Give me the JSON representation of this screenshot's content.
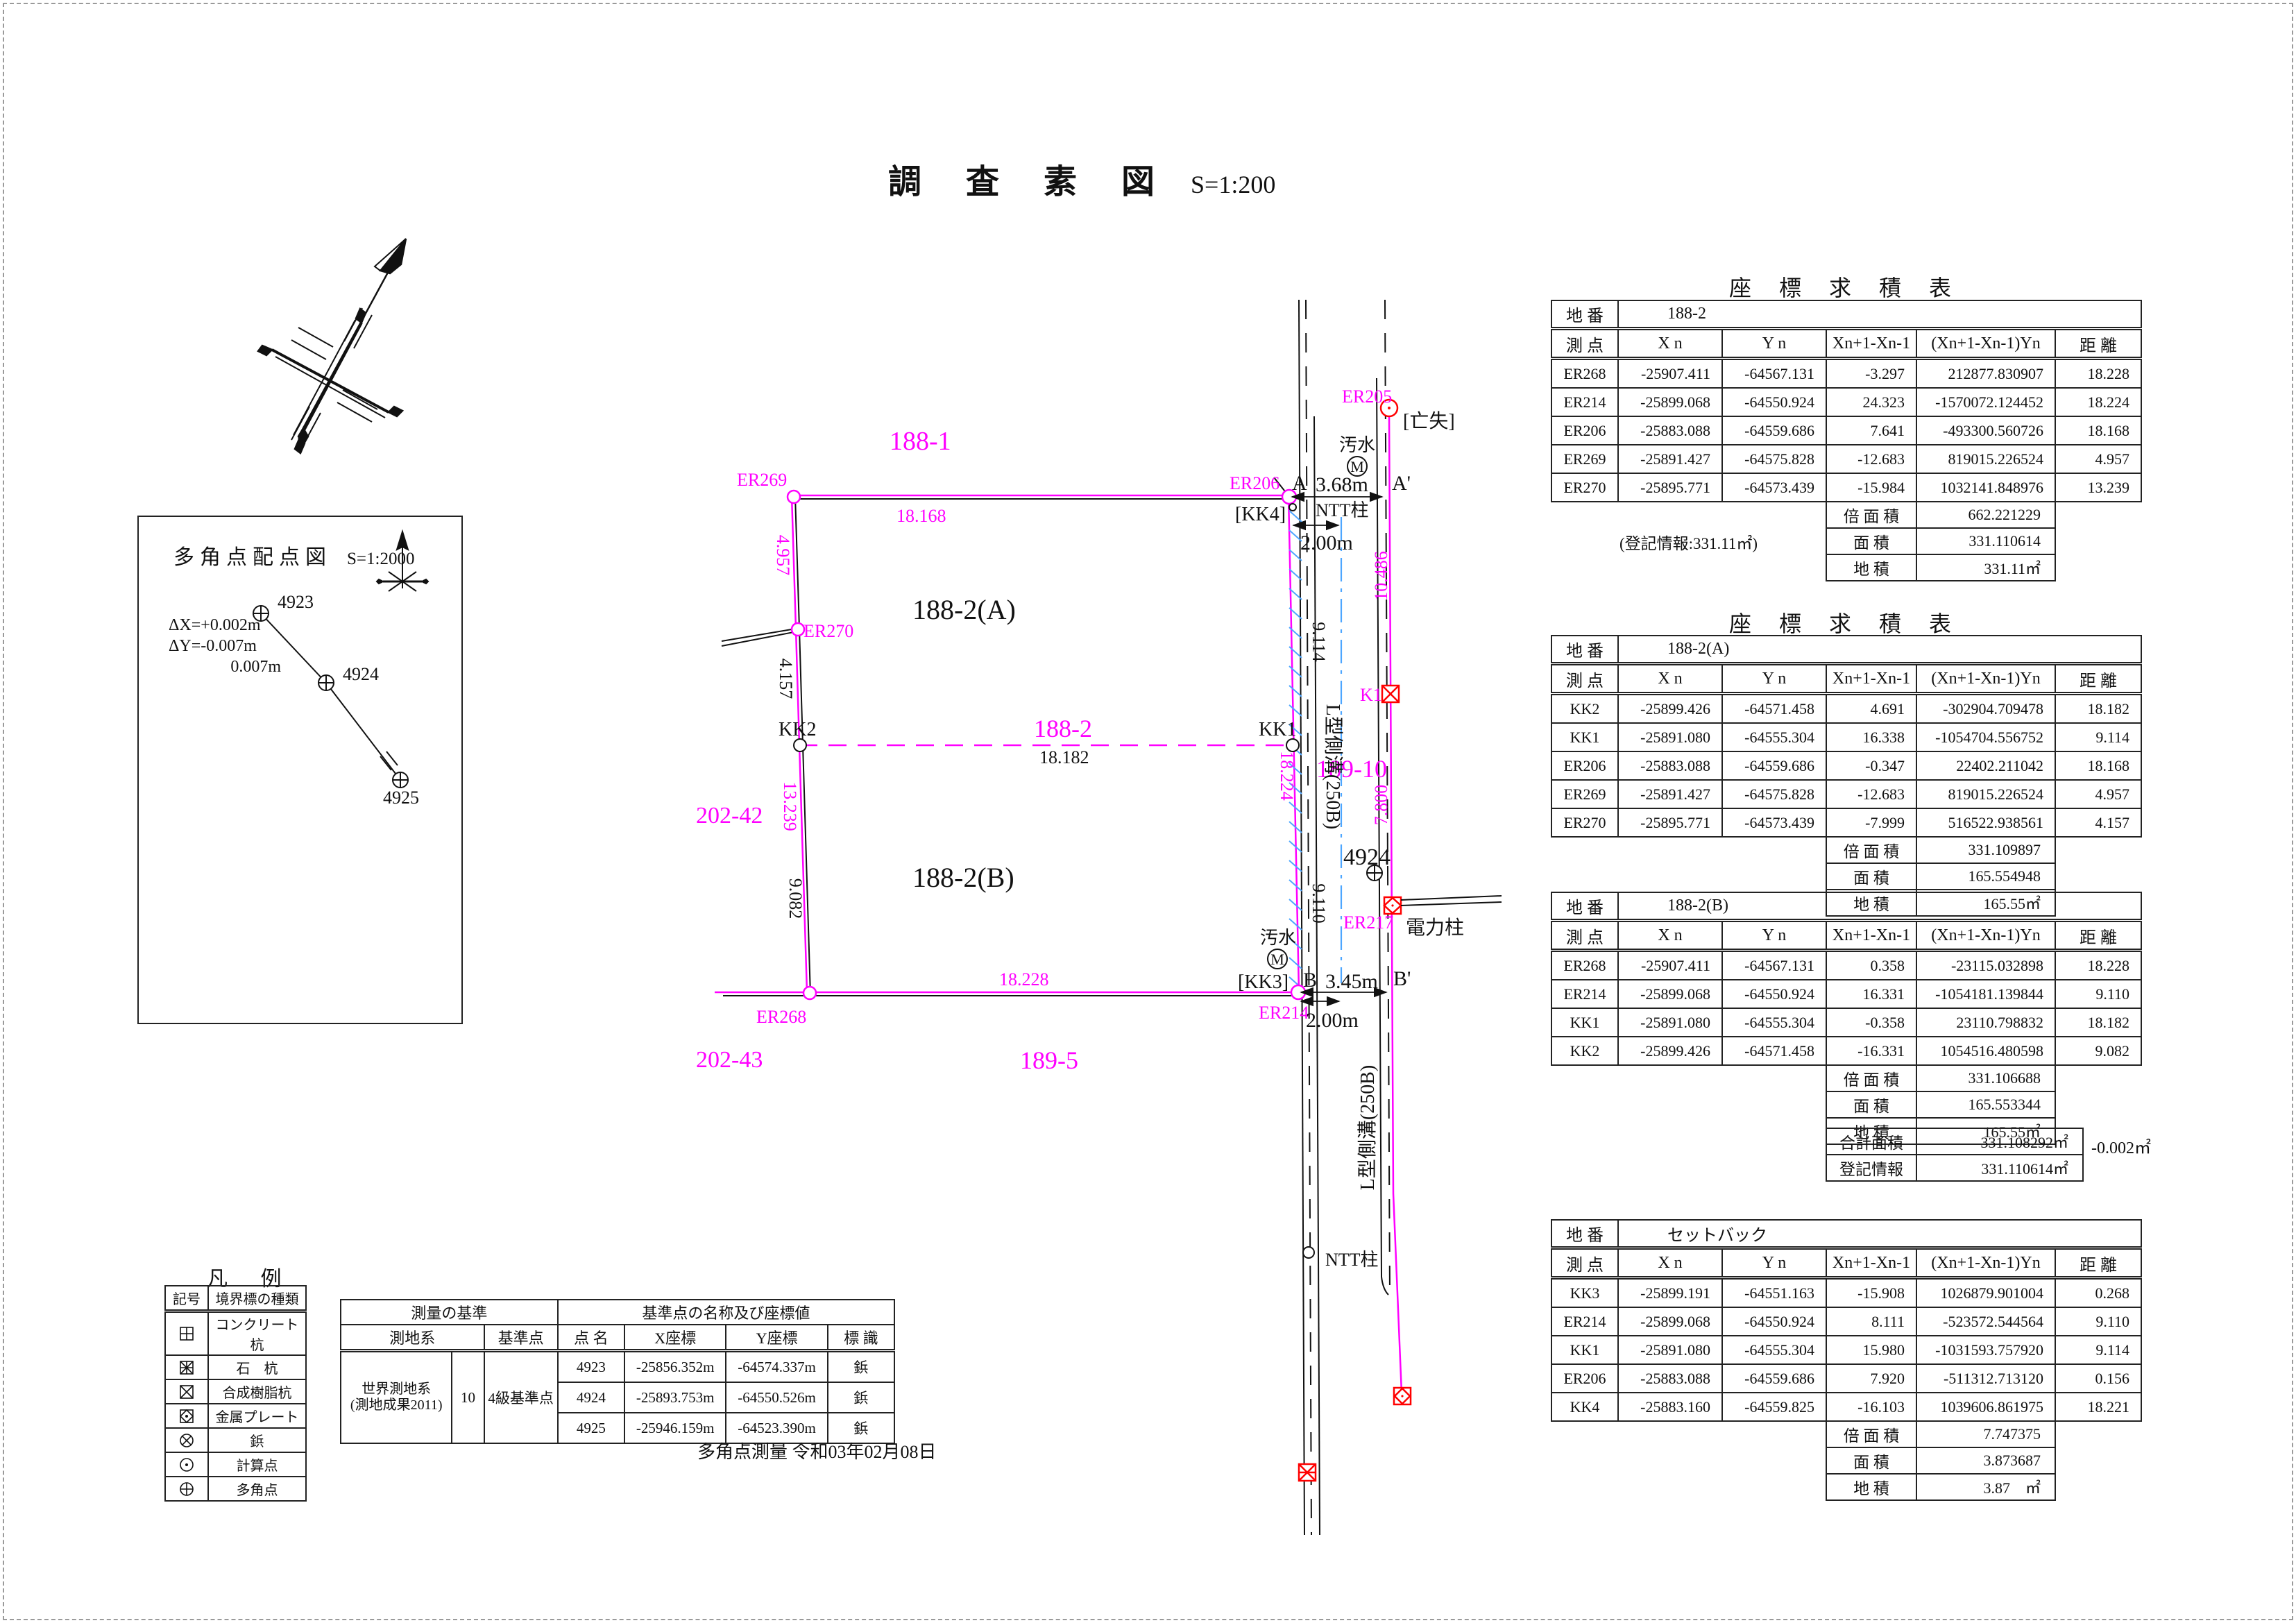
{
  "page": {
    "title_main": "調 査 素 図",
    "title_scale": "S=1:200"
  },
  "inset": {
    "title": "多角点配点図",
    "scale": "S=1:2000",
    "dx": "ΔX=+0.002m",
    "dy": "ΔY=-0.007m",
    "dist": "0.007m",
    "p1": "4923",
    "p2": "4924",
    "p3": "4925"
  },
  "legend": {
    "title": "凡 例",
    "col1": "記号",
    "col2": "境界標の種類",
    "items": [
      {
        "symbol": "concrete-pile-icon",
        "label": "コンクリート杭"
      },
      {
        "symbol": "stone-pile-icon",
        "label": "石　杭"
      },
      {
        "symbol": "resin-pile-icon",
        "label": "合成樹脂杭"
      },
      {
        "symbol": "metal-plate-icon",
        "label": "金属プレート"
      },
      {
        "symbol": "tack-icon",
        "label": "鋲"
      },
      {
        "symbol": "calc-point-icon",
        "label": "計算点"
      },
      {
        "symbol": "traverse-point-icon",
        "label": "多角点"
      }
    ]
  },
  "basis": {
    "h_left": "測量の基準",
    "h_right": "基準点の名称及び座標値",
    "h_datum": "測地系",
    "h_kijun": "基準点",
    "h_name": "点 名",
    "h_x": "X座標",
    "h_y": "Y座標",
    "h_mark": "標 識",
    "datum1": "世界測地系",
    "datum2": "(測地成果2011)",
    "num": "10",
    "kijun": "4級基準点",
    "rows": [
      [
        "4923",
        "-25856.352m",
        "-64574.337m",
        "鋲"
      ],
      [
        "4924",
        "-25893.753m",
        "-64550.526m",
        "鋲"
      ],
      [
        "4925",
        "-25946.159m",
        "-64523.390m",
        "鋲"
      ]
    ],
    "date": "多角点測量 令和03年02月08日"
  },
  "kyuseki": {
    "title": "座 標 求 積 表",
    "chiban_label": "地 番",
    "headers": [
      "測 点",
      "X n",
      "Y n",
      "Xn+1-Xn-1",
      "(Xn+1-Xn-1)Yn",
      "距 離"
    ],
    "f1": "倍 面 積",
    "f2": "面 積",
    "f3": "地 積"
  },
  "tables": {
    "t1": {
      "chiban": "188-2",
      "rows": [
        [
          "ER268",
          "-25907.411",
          "-64567.131",
          "-3.297",
          "212877.830907",
          "18.228"
        ],
        [
          "ER214",
          "-25899.068",
          "-64550.924",
          "24.323",
          "-1570072.124452",
          "18.224"
        ],
        [
          "ER206",
          "-25883.088",
          "-64559.686",
          "7.641",
          "-493300.560726",
          "18.168"
        ],
        [
          "ER269",
          "-25891.427",
          "-64575.828",
          "-12.683",
          "819015.226524",
          "4.957"
        ],
        [
          "ER270",
          "-25895.771",
          "-64573.439",
          "-15.984",
          "1032141.848976",
          "13.239"
        ]
      ],
      "note": "(登記情報:331.11㎡)",
      "bai": "662.221229",
      "men": "331.110614",
      "chiseki": "331.11㎡"
    },
    "t2": {
      "chiban": "188-2(A)",
      "rows": [
        [
          "KK2",
          "-25899.426",
          "-64571.458",
          "4.691",
          "-302904.709478",
          "18.182"
        ],
        [
          "KK1",
          "-25891.080",
          "-64555.304",
          "16.338",
          "-1054704.556752",
          "9.114"
        ],
        [
          "ER206",
          "-25883.088",
          "-64559.686",
          "-0.347",
          "22402.211042",
          "18.168"
        ],
        [
          "ER269",
          "-25891.427",
          "-64575.828",
          "-12.683",
          "819015.226524",
          "4.957"
        ],
        [
          "ER270",
          "-25895.771",
          "-64573.439",
          "-7.999",
          "516522.938561",
          "4.157"
        ]
      ],
      "note": "",
      "bai": "331.109897",
      "men": "165.554948",
      "chiseki": "165.55㎡"
    },
    "t3": {
      "chiban": "188-2(B)",
      "rows": [
        [
          "ER268",
          "-25907.411",
          "-64567.131",
          "0.358",
          "-23115.032898",
          "18.228"
        ],
        [
          "ER214",
          "-25899.068",
          "-64550.924",
          "16.331",
          "-1054181.139844",
          "9.110"
        ],
        [
          "KK1",
          "-25891.080",
          "-64555.304",
          "-0.358",
          "23110.798832",
          "18.182"
        ],
        [
          "KK2",
          "-25899.426",
          "-64571.458",
          "-16.331",
          "1054516.480598",
          "9.082"
        ]
      ],
      "note": "",
      "bai": "331.106688",
      "men": "165.553344",
      "chiseki": "165.55㎡"
    },
    "t4": {
      "chiban": "セットバック",
      "rows": [
        [
          "KK3",
          "-25899.191",
          "-64551.163",
          "-15.908",
          "1026879.901004",
          "0.268"
        ],
        [
          "ER214",
          "-25899.068",
          "-64550.924",
          "8.111",
          "-523572.544564",
          "9.110"
        ],
        [
          "KK1",
          "-25891.080",
          "-64555.304",
          "15.980",
          "-1031593.757920",
          "9.114"
        ],
        [
          "ER206",
          "-25883.088",
          "-64559.686",
          "7.920",
          "-511312.713120",
          "0.156"
        ],
        [
          "KK4",
          "-25883.160",
          "-64559.825",
          "-16.103",
          "1039606.861975",
          "18.221"
        ]
      ],
      "note": "",
      "bai": "7.747375",
      "men": "3.873687",
      "chiseki": "3.87　㎡"
    }
  },
  "sum": {
    "l1": "合計面積",
    "v1": "331.108292㎡",
    "diff": "-0.002㎡",
    "l2": "登記情報",
    "v2": "331.110614㎡"
  },
  "drawing": {
    "parcels": {
      "n188_1": "188-1",
      "n188_2": "188-2",
      "n188_2a": "188-2(A)",
      "n188_2b": "188-2(B)",
      "n189_5": "189-5",
      "n189_10": "189-10",
      "n202_42": "202-42",
      "n202_43": "202-43"
    },
    "points": {
      "er269": "ER269",
      "er270": "ER270",
      "er268": "ER268",
      "er206": "ER206",
      "er214": "ER214",
      "er205": "ER205",
      "er217": "ER217",
      "kk1": "KK1",
      "kk2": "KK2",
      "kk3": "[KK3]",
      "kk4": "[KK4]",
      "k1": "K1",
      "a": "A",
      "a_prime": "A'",
      "b": "B",
      "b_prime": "B'",
      "p4924": "4924",
      "lost": "[亡失]"
    },
    "dims": {
      "road_a": "3.68m",
      "road_b": "3.45m",
      "offset_a": "2.00m",
      "offset_b": "2.00m",
      "top": "18.168",
      "mid": "18.182",
      "bottom": "18.228",
      "right": "18.224",
      "left1": "4.957",
      "left2": "4.157",
      "left3": "13.239",
      "left4": "9.082",
      "r1": "9.114",
      "r2": "9.110",
      "rr1": "10.486",
      "rr2": "7.800"
    },
    "features": {
      "gutter1": "L型側溝(250B)",
      "gutter2": "L型側溝(250B)",
      "ntt1": "NTT柱",
      "ntt2": "NTT柱",
      "sewer1": "汚水",
      "sewer2": "汚水",
      "manhole1": "M",
      "manhole2": "M",
      "power": "電力柱"
    }
  }
}
